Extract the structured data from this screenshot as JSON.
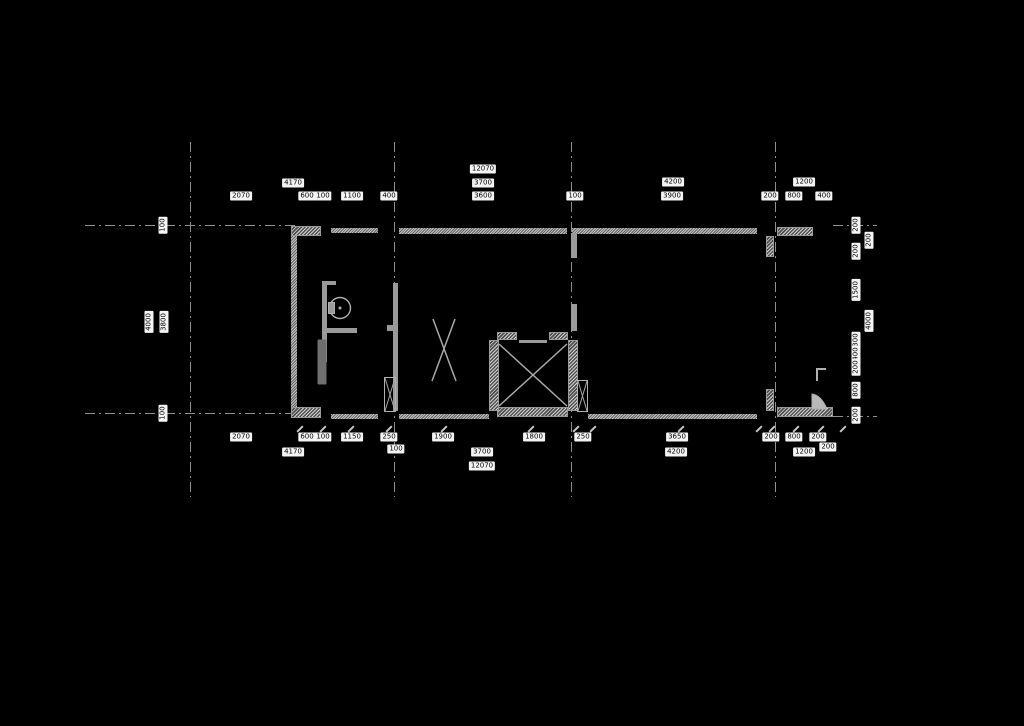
{
  "meta": {
    "drawing_type": "architectural-floor-plan",
    "background_color": "#000000",
    "wall_color": "#a8a8a8",
    "axis_color": "#8f8f8f",
    "label_bg_color": "#f4f4f4",
    "label_text_color": "#000000"
  },
  "plan": {
    "axes": {
      "vertical": [
        {
          "x": 190
        },
        {
          "x": 394
        },
        {
          "x": 571
        },
        {
          "x": 775
        }
      ],
      "vertical_y1": 142,
      "vertical_y2": 497,
      "horizontal": [
        {
          "y": 225,
          "x1": 85,
          "x2": 299
        },
        {
          "y": 225,
          "x1": 833,
          "x2": 877
        },
        {
          "y": 413,
          "x1": 85,
          "x2": 299
        },
        {
          "y": 416,
          "x1": 833,
          "x2": 877
        }
      ]
    },
    "walls": [
      {
        "x": 291,
        "y": 226,
        "w": 30,
        "h": 10,
        "s": "hatch",
        "n": "top-wall-corner-left"
      },
      {
        "x": 331,
        "y": 228,
        "w": 47,
        "h": 5,
        "s": "thin",
        "n": "top-wall-segment"
      },
      {
        "x": 399,
        "y": 228,
        "w": 168,
        "h": 6,
        "s": "thin",
        "n": "top-wall-segment"
      },
      {
        "x": 572,
        "y": 228,
        "w": 185,
        "h": 6,
        "s": "thin",
        "n": "top-wall-segment"
      },
      {
        "x": 777,
        "y": 227,
        "w": 36,
        "h": 9,
        "s": "hatch",
        "n": "top-wall-corner-right"
      },
      {
        "x": 291,
        "y": 407,
        "w": 30,
        "h": 11,
        "s": "hatch",
        "n": "bottom-wall-corner-left"
      },
      {
        "x": 331,
        "y": 414,
        "w": 47,
        "h": 5,
        "s": "thin",
        "n": "bottom-wall-segment"
      },
      {
        "x": 399,
        "y": 414,
        "w": 90,
        "h": 5,
        "s": "thin",
        "n": "bottom-wall-segment"
      },
      {
        "x": 497,
        "y": 407,
        "w": 71,
        "h": 10,
        "s": "hatch",
        "n": "shaft-bottom-wall"
      },
      {
        "x": 588,
        "y": 414,
        "w": 169,
        "h": 5,
        "s": "thin",
        "n": "bottom-wall-segment"
      },
      {
        "x": 777,
        "y": 407,
        "w": 56,
        "h": 10,
        "s": "hatch",
        "n": "bottom-wall-right"
      },
      {
        "x": 291,
        "y": 236,
        "w": 6,
        "h": 171,
        "s": "thin",
        "n": "left-exterior-wall"
      },
      {
        "x": 766,
        "y": 236,
        "w": 8,
        "h": 21,
        "s": "hatch",
        "n": "pier-axis4-top"
      },
      {
        "x": 766,
        "y": 389,
        "w": 8,
        "h": 22,
        "s": "hatch",
        "n": "pier-axis4-bottom"
      },
      {
        "x": 322,
        "y": 281,
        "w": 14,
        "h": 4,
        "s": "solid",
        "n": "bath-wall-stub"
      },
      {
        "x": 322,
        "y": 281,
        "w": 5,
        "h": 81,
        "s": "solid",
        "n": "bath-wall-vertical"
      },
      {
        "x": 322,
        "y": 362,
        "w": 5,
        "h": 45,
        "s": "dim",
        "n": "bath-wall-lower"
      },
      {
        "x": 322,
        "y": 328,
        "w": 35,
        "h": 5,
        "s": "solid",
        "n": "bath-partition"
      },
      {
        "x": 393,
        "y": 283,
        "w": 5,
        "h": 128,
        "s": "solid",
        "n": "mid-wall-vertical"
      },
      {
        "x": 387,
        "y": 325,
        "w": 6,
        "h": 6,
        "s": "solid",
        "n": "mid-wall-stub"
      },
      {
        "x": 571,
        "y": 233,
        "w": 6,
        "h": 25,
        "s": "solid",
        "n": "right-partition-upper"
      },
      {
        "x": 571,
        "y": 304,
        "w": 6,
        "h": 27,
        "s": "solid",
        "n": "right-partition-lower"
      },
      {
        "x": 497,
        "y": 332,
        "w": 20,
        "h": 8,
        "s": "hatch",
        "n": "shaft-jamb-left"
      },
      {
        "x": 549,
        "y": 332,
        "w": 19,
        "h": 8,
        "s": "hatch",
        "n": "shaft-jamb-right"
      },
      {
        "x": 519,
        "y": 340,
        "w": 28,
        "h": 3,
        "s": "solid",
        "n": "shaft-door-line"
      },
      {
        "x": 489,
        "y": 340,
        "w": 10,
        "h": 71,
        "s": "hatch",
        "n": "shaft-wall-left"
      },
      {
        "x": 568,
        "y": 340,
        "w": 10,
        "h": 71,
        "s": "hatch",
        "n": "shaft-wall-right"
      }
    ],
    "ticks": {
      "y": 425,
      "xs": [
        299,
        322,
        350,
        388,
        443,
        530,
        575,
        592,
        680,
        758,
        771,
        795,
        820,
        842
      ]
    },
    "labels": [
      {
        "t": "12070",
        "x": 483,
        "y": 169
      },
      {
        "t": "4170",
        "x": 293,
        "y": 183
      },
      {
        "t": "3700",
        "x": 483,
        "y": 183
      },
      {
        "t": "4200",
        "x": 673,
        "y": 182
      },
      {
        "t": "1200",
        "x": 804,
        "y": 182
      },
      {
        "t": "2070",
        "x": 241,
        "y": 196
      },
      {
        "t": "600",
        "x": 307,
        "y": 196
      },
      {
        "t": "100",
        "x": 323,
        "y": 196
      },
      {
        "t": "1100",
        "x": 352,
        "y": 196
      },
      {
        "t": "400",
        "x": 389,
        "y": 196
      },
      {
        "t": "3600",
        "x": 483,
        "y": 196
      },
      {
        "t": "100",
        "x": 575,
        "y": 196
      },
      {
        "t": "3900",
        "x": 672,
        "y": 196
      },
      {
        "t": "200",
        "x": 770,
        "y": 196
      },
      {
        "t": "800",
        "x": 794,
        "y": 196
      },
      {
        "t": "400",
        "x": 824,
        "y": 196
      },
      {
        "t": "2070",
        "x": 241,
        "y": 437
      },
      {
        "t": "600",
        "x": 307,
        "y": 437
      },
      {
        "t": "100",
        "x": 323,
        "y": 437
      },
      {
        "t": "1150",
        "x": 352,
        "y": 437
      },
      {
        "t": "250",
        "x": 389,
        "y": 437
      },
      {
        "t": "1900",
        "x": 443,
        "y": 437
      },
      {
        "t": "1800",
        "x": 534,
        "y": 437
      },
      {
        "t": "250",
        "x": 583,
        "y": 437
      },
      {
        "t": "3650",
        "x": 677,
        "y": 437
      },
      {
        "t": "200",
        "x": 771,
        "y": 437
      },
      {
        "t": "800",
        "x": 794,
        "y": 437
      },
      {
        "t": "200",
        "x": 818,
        "y": 437
      },
      {
        "t": "4170",
        "x": 293,
        "y": 452
      },
      {
        "t": "100",
        "x": 396,
        "y": 449
      },
      {
        "t": "3700",
        "x": 482,
        "y": 452
      },
      {
        "t": "4200",
        "x": 676,
        "y": 452
      },
      {
        "t": "1200",
        "x": 804,
        "y": 452
      },
      {
        "t": "200",
        "x": 828,
        "y": 447
      },
      {
        "t": "12070",
        "x": 482,
        "y": 466
      },
      {
        "t": "100",
        "x": 163,
        "y": 225,
        "rot": 1
      },
      {
        "t": "4000",
        "x": 149,
        "y": 322,
        "rot": 1
      },
      {
        "t": "3800",
        "x": 164,
        "y": 322,
        "rot": 1
      },
      {
        "t": "100",
        "x": 163,
        "y": 413,
        "rot": 1
      },
      {
        "t": "200",
        "x": 856,
        "y": 225,
        "rot": 1
      },
      {
        "t": "200",
        "x": 869,
        "y": 240,
        "rot": 1
      },
      {
        "t": "200",
        "x": 856,
        "y": 251,
        "rot": 1
      },
      {
        "t": "1500",
        "x": 856,
        "y": 290,
        "rot": 1
      },
      {
        "t": "4000",
        "x": 869,
        "y": 321,
        "rot": 1
      },
      {
        "t": "300",
        "x": 856,
        "y": 340,
        "rot": 1
      },
      {
        "t": "400",
        "x": 856,
        "y": 354,
        "rot": 1
      },
      {
        "t": "200",
        "x": 856,
        "y": 367,
        "rot": 1
      },
      {
        "t": "800",
        "x": 856,
        "y": 390,
        "rot": 1
      },
      {
        "t": "200",
        "x": 856,
        "y": 415,
        "rot": 1
      }
    ],
    "shapes": [
      {
        "kind": "line",
        "x1": 499,
        "y1": 344,
        "x2": 567,
        "y2": 406,
        "w": 1.5,
        "n": "elevator-cross-line"
      },
      {
        "kind": "line",
        "x1": 567,
        "y1": 344,
        "x2": 499,
        "y2": 406,
        "w": 1.5,
        "n": "elevator-cross-line"
      },
      {
        "kind": "line",
        "x1": 433,
        "y1": 319,
        "x2": 456,
        "y2": 381,
        "w": 1.5,
        "n": "stair-cross-line"
      },
      {
        "kind": "line",
        "x1": 455,
        "y1": 319,
        "x2": 432,
        "y2": 381,
        "w": 1.5,
        "n": "stair-cross-line"
      },
      {
        "kind": "circle",
        "cx": 340,
        "cy": 308,
        "r": 10.5,
        "w": 1.4,
        "fill": "none",
        "n": "toilet-bowl"
      },
      {
        "kind": "circle",
        "cx": 340,
        "cy": 308,
        "r": 1.5,
        "w": 0,
        "fill": "#b0b0b0",
        "n": "toilet-drain"
      },
      {
        "kind": "rect",
        "x": 328.5,
        "y": 302.5,
        "w": 6,
        "h": 11,
        "sw": 1,
        "fill": "#9a9a9a",
        "n": "toilet-tank"
      },
      {
        "kind": "rect",
        "x": 384.5,
        "y": 377.5,
        "w": 11,
        "h": 34,
        "sw": 1,
        "fill": "none",
        "n": "window-jamb"
      },
      {
        "kind": "line",
        "x1": 385,
        "y1": 378,
        "x2": 395,
        "y2": 411,
        "w": 1,
        "n": "window-jamb-cross"
      },
      {
        "kind": "line",
        "x1": 395,
        "y1": 378,
        "x2": 385,
        "y2": 411,
        "w": 1,
        "n": "window-jamb-cross"
      },
      {
        "kind": "rect",
        "x": 577.5,
        "y": 380.5,
        "w": 10,
        "h": 31,
        "sw": 1,
        "fill": "none",
        "n": "window-jamb"
      },
      {
        "kind": "line",
        "x1": 578,
        "y1": 381,
        "x2": 587,
        "y2": 411,
        "w": 1,
        "n": "window-jamb-cross"
      },
      {
        "kind": "line",
        "x1": 587,
        "y1": 381,
        "x2": 578,
        "y2": 411,
        "w": 1,
        "n": "window-jamb-cross"
      },
      {
        "kind": "path",
        "d": "M826,369 L817,369 L817,381",
        "w": 2,
        "fill": "none",
        "n": "door-stop"
      },
      {
        "kind": "path",
        "d": "M812,409 L812,394 Q821,395 827,409 Z",
        "w": 1,
        "fill": "#b8b8b8",
        "n": "door-swing"
      }
    ]
  }
}
